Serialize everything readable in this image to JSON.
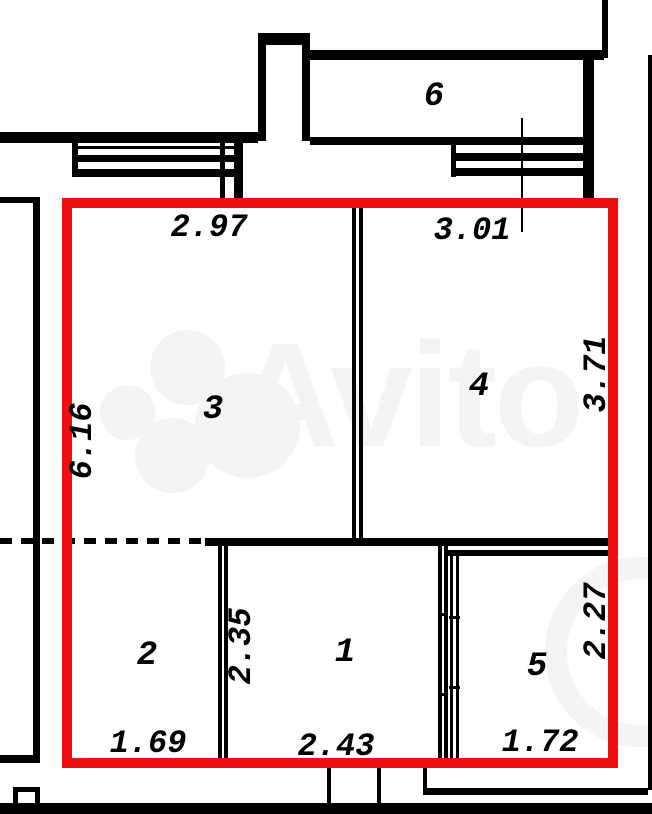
{
  "plan": {
    "watermark": {
      "text": "Avito"
    },
    "colors": {
      "highlight_border": "#ee1010",
      "walls": "#000000",
      "watermark": "#f4f4f4"
    },
    "rooms": [
      {
        "number": "1"
      },
      {
        "number": "2"
      },
      {
        "number": "3"
      },
      {
        "number": "4"
      },
      {
        "number": "5"
      },
      {
        "number": "6"
      }
    ],
    "dimensions": {
      "top_left_width": "2.97",
      "top_right_width": "3.01",
      "left_height": "6.16",
      "right_upper_height": "3.71",
      "room1_left_height": "2.35",
      "room5_right_height": "2.27",
      "bottom_left_width": "1.69",
      "bottom_middle_width": "2.43",
      "bottom_right_width": "1.72"
    }
  }
}
